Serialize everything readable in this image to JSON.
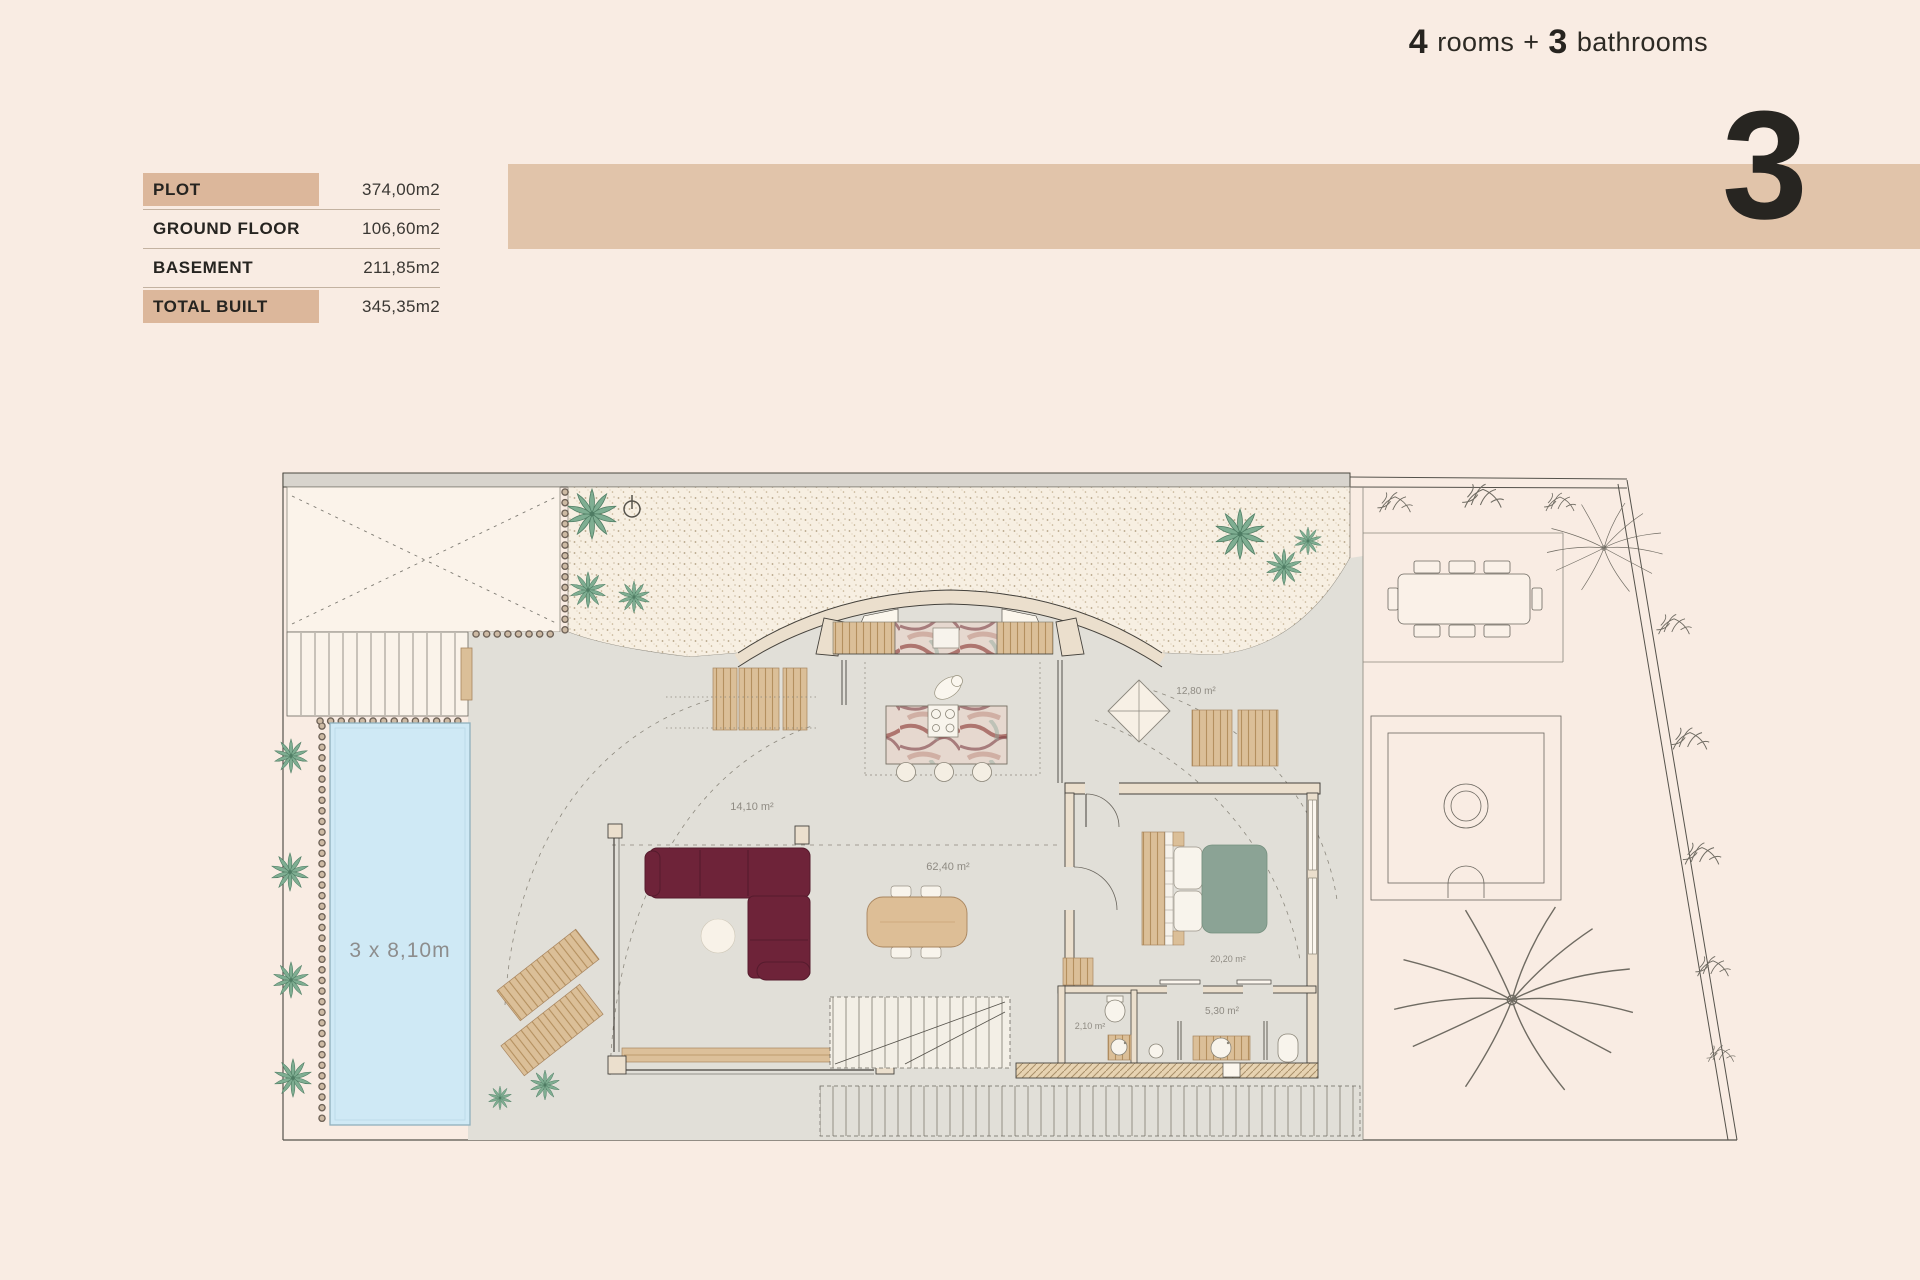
{
  "header": {
    "unit_number": "3",
    "rooms_count": "4",
    "rooms_word": "rooms",
    "plus": "+",
    "bathrooms_count": "3",
    "bathrooms_word": "bathrooms"
  },
  "areas_table": {
    "rows": [
      {
        "label": "PLOT",
        "value": "374,00m2"
      },
      {
        "label": "GROUND FLOOR",
        "value": "106,60m2"
      },
      {
        "label": "BASEMENT",
        "value": "211,85m2"
      },
      {
        "label": "TOTAL BUILT",
        "value": "345,35m2"
      }
    ]
  },
  "floor_plan": {
    "pool_label": "3 x 8,10m",
    "room_areas": {
      "terrace_left": "14,10 m²",
      "living_dining": "62,40 m²",
      "terrace_right": "12,80 m²",
      "bedroom": "20,20 m²",
      "toilet": "2,10 m²",
      "bathroom": "5,30 m²"
    }
  },
  "colors": {
    "page_bg": "#f9ece3",
    "band": "#e1c4aa",
    "table_highlight": "#dcb79b",
    "text_dark": "#2d2a25",
    "pool_water": "#cfe9f5",
    "hardscape": "#e1dfd8",
    "wood": "#dbbf98",
    "wall_cream": "#ebdfcd",
    "sofa_burgundy": "#6e2339",
    "bed_sage": "#8ba395",
    "plant_teal": "#7fae92",
    "gravel": "#f7efe2"
  }
}
